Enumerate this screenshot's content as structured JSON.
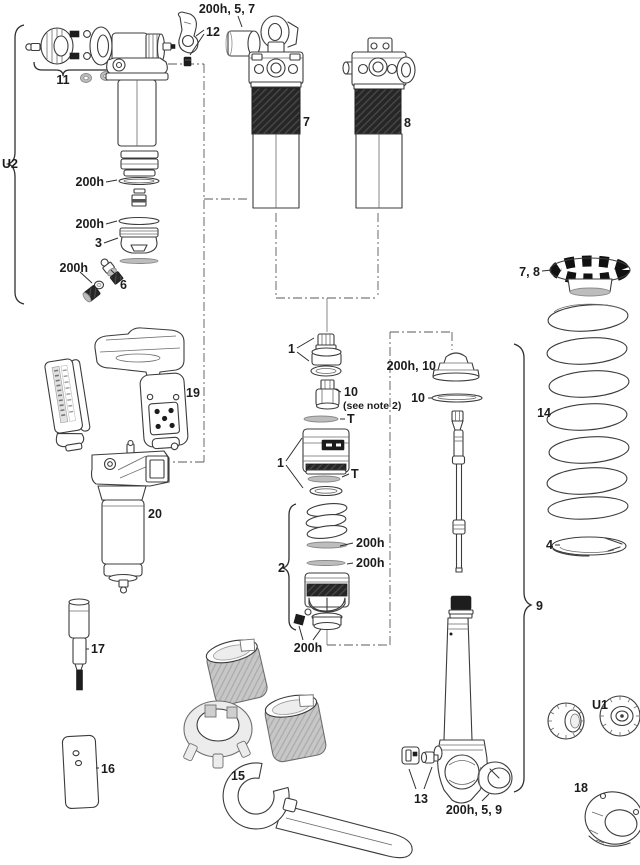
{
  "diagram": {
    "kind": "exploded-parts-diagram",
    "colors": {
      "background": "#ffffff",
      "line": "#3c3c3c",
      "dark_fill": "#1d1d1d",
      "gray_fill": "#c7c7c7"
    },
    "labels": {
      "bushing_top": "200h, 5, 7",
      "lever": "12",
      "knob_kit": "11",
      "u2": "U2",
      "seal_a": "200h",
      "seal_b": "200h",
      "piston_3": "3",
      "seal_c": "200h",
      "valve_6": "6",
      "shock_left": "7",
      "shock_right": "8",
      "preload_ring": "7, 8",
      "coil_spring": "14",
      "spring_seat": "4",
      "sealhead_1a": "1",
      "valve_10a": "10",
      "see_note": "(see note 2)",
      "t_upper": "T",
      "piston_1b": "1",
      "t_lower": "T",
      "bumper": "200h, 10",
      "washer_10b": "10",
      "damper_9": "9",
      "stack_2": "2",
      "seal_d": "200h",
      "seal_e": "200h",
      "seal_f": "200h",
      "module_19": "19",
      "body_20": "20",
      "tool_17": "17",
      "block_16": "16",
      "wrench_15": "15",
      "hardware_13": "13",
      "bushing_bottom": "200h, 5, 9",
      "u1": "U1",
      "mount_18": "18"
    }
  }
}
